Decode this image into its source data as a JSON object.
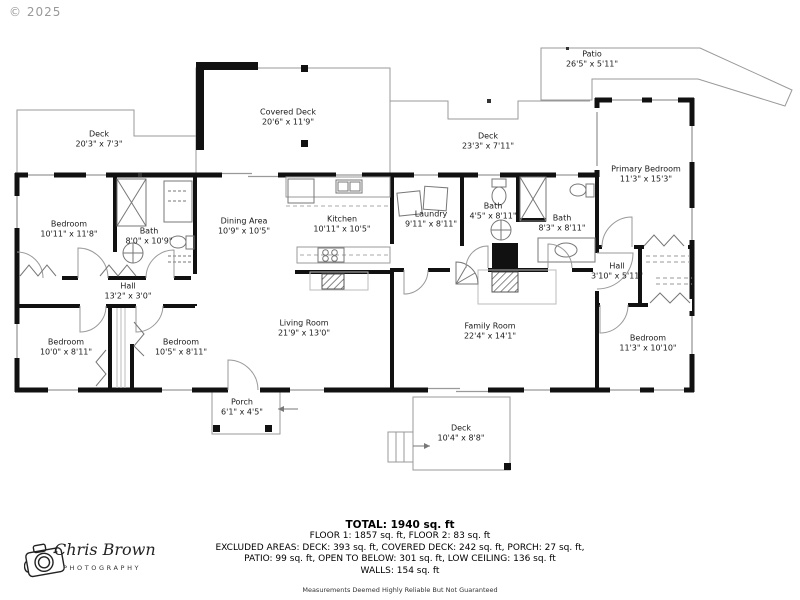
{
  "copyright": "© 2025",
  "rooms": [
    {
      "name": "Patio",
      "dims": "26'5\" x 5'11\""
    },
    {
      "name": "Covered Deck",
      "dims": "20'6\" x 11'9\""
    },
    {
      "name": "Deck",
      "dims": "20'3\" x 7'3\""
    },
    {
      "name": "Deck",
      "dims": "23'3\" x 7'11\""
    },
    {
      "name": "Primary Bedroom",
      "dims": "11'3\" x 15'3\""
    },
    {
      "name": "Bedroom",
      "dims": "10'11\" x 11'8\""
    },
    {
      "name": "Bath",
      "dims": "8'0\" x 10'9\""
    },
    {
      "name": "Hall",
      "dims": "13'2\" x 3'0\""
    },
    {
      "name": "Dining Area",
      "dims": "10'9\" x 10'5\""
    },
    {
      "name": "Kitchen",
      "dims": "10'11\" x 10'5\""
    },
    {
      "name": "Laundry",
      "dims": "9'11\" x 8'11\""
    },
    {
      "name": "Bath",
      "dims": "4'5\" x 8'11\""
    },
    {
      "name": "Bath",
      "dims": "8'3\" x 8'11\""
    },
    {
      "name": "Hall",
      "dims": "3'10\" x 5'11\""
    },
    {
      "name": "Living Room",
      "dims": "21'9\" x 13'0\""
    },
    {
      "name": "Family Room",
      "dims": "22'4\" x 14'1\""
    },
    {
      "name": "Bedroom",
      "dims": "10'0\" x 8'11\""
    },
    {
      "name": "Bedroom",
      "dims": "10'5\" x 8'11\""
    },
    {
      "name": "Bedroom",
      "dims": "11'3\" x 10'10\""
    },
    {
      "name": "Porch",
      "dims": "6'1\" x 4'5\""
    },
    {
      "name": "Deck",
      "dims": "10'4\" x 8'8\""
    }
  ],
  "footer": {
    "total": "TOTAL: 1940 sq. ft",
    "line1": "FLOOR 1: 1857 sq. ft, FLOOR 2: 83 sq. ft",
    "line2": "EXCLUDED AREAS: DECK: 393 sq. ft, COVERED DECK: 242 sq. ft, PORCH: 27 sq. ft,",
    "line3": "PATIO: 99 sq. ft, OPEN TO BELOW: 301 sq. ft, LOW CEILING: 136 sq. ft",
    "line4": "WALLS: 154 sq. ft",
    "disclaimer": "Measurements Deemed Highly Reliable But Not Guaranteed"
  },
  "logo": {
    "name": "Chris Brown",
    "subtitle": "PHOTOGRAPHY"
  },
  "colors": {
    "wall": "#111111",
    "thin_line": "#999999",
    "text": "#1a1a1a"
  }
}
